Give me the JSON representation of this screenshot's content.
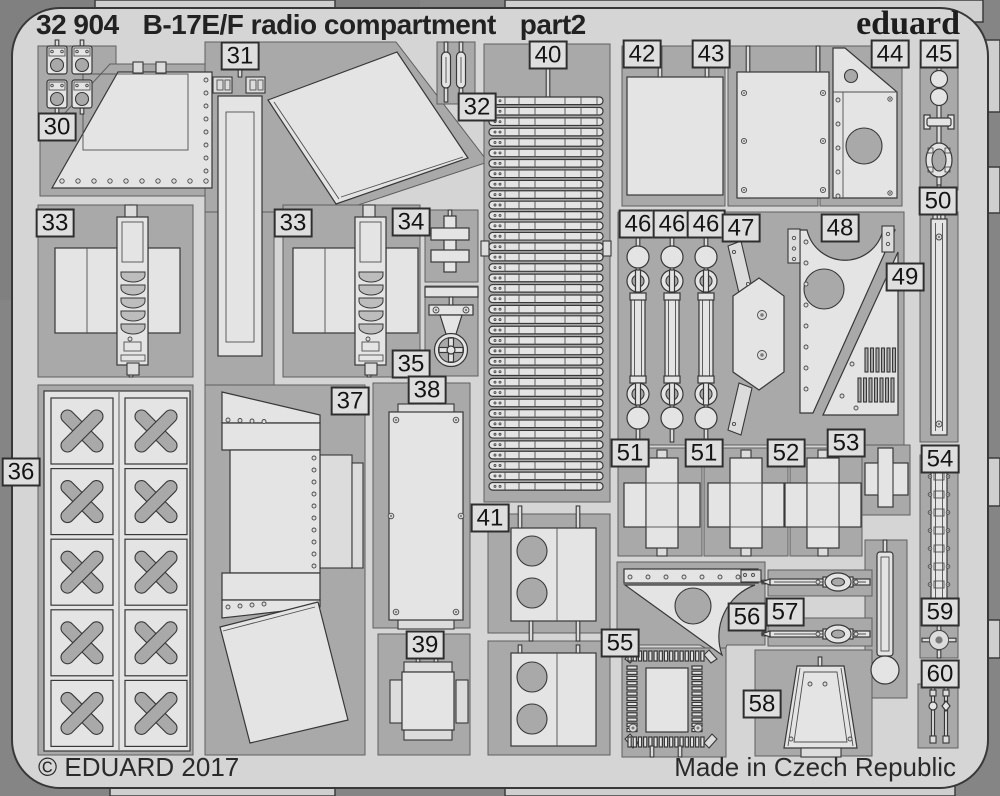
{
  "header": {
    "catalog_number": "32 904",
    "title": "B-17E/F radio compartment",
    "part_suffix": "part2",
    "brand": "eduard"
  },
  "footer": {
    "copyright": "© EDUARD 2017",
    "origin": "Made in Czech Republic"
  },
  "sheet": {
    "description": "photo-etched metal fret with numbered parts",
    "part_labels": [
      "30",
      "31",
      "32",
      "33",
      "33",
      "34",
      "35",
      "36",
      "37",
      "38",
      "39",
      "40",
      "41",
      "42",
      "43",
      "44",
      "45",
      "46",
      "46",
      "46",
      "47",
      "48",
      "49",
      "50",
      "51",
      "51",
      "52",
      "53",
      "54",
      "55",
      "56",
      "57",
      "58",
      "59",
      "60"
    ]
  },
  "colors": {
    "background": "#8a8a8a",
    "sheet": "#d5d5d5",
    "recess": "#a9a9a9",
    "part": "#e4e4e4",
    "outline": "#383838",
    "text": "#222222"
  }
}
